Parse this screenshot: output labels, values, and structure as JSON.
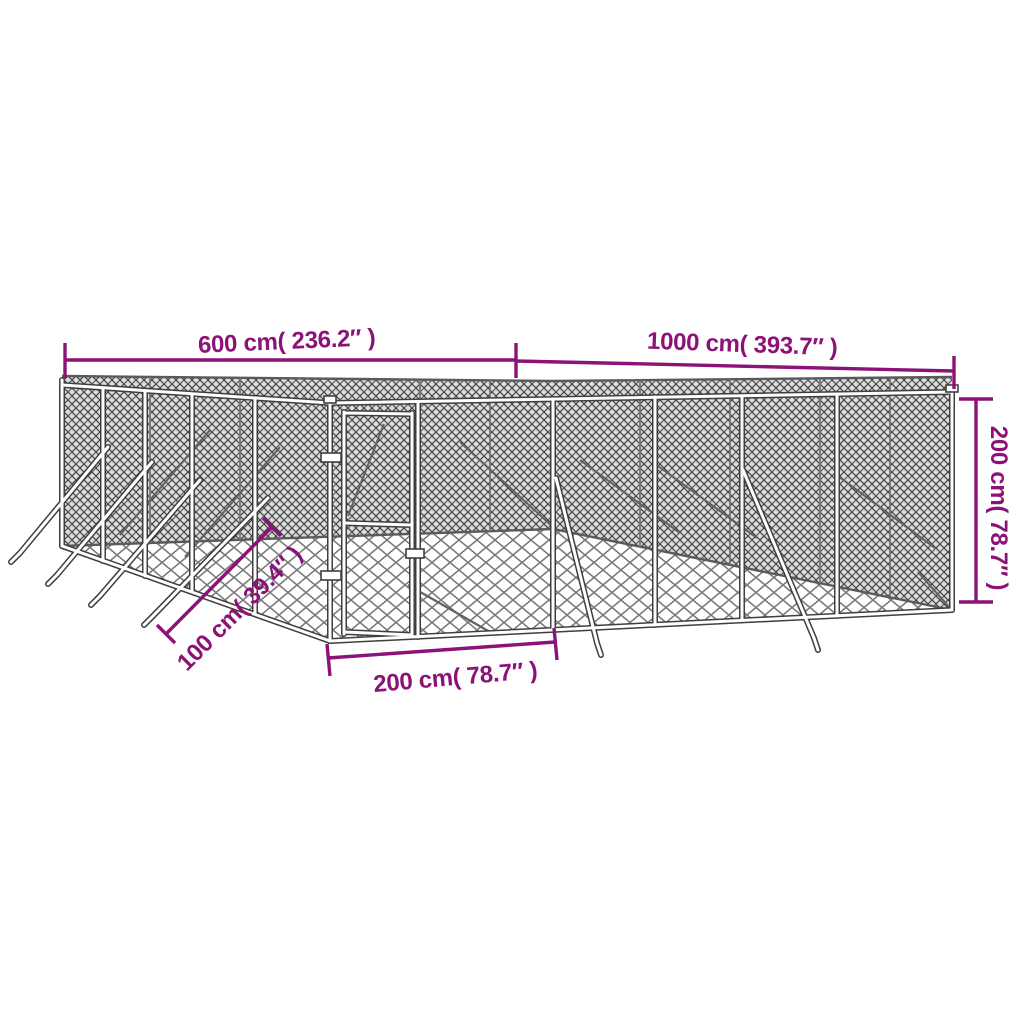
{
  "figure": {
    "kind": "product-dimension-diagram",
    "subject": "chain-link-dog-kennel-with-gate",
    "background": "#ffffff"
  },
  "colors": {
    "dimension_accent": "#8C1277",
    "frame_outline": "#3f3f3f",
    "mesh_dark_line": "#3d3d3d",
    "mesh_light_line": "#787878"
  },
  "dimensions": {
    "front_width": {
      "label": "600 cm( 236.2″ )"
    },
    "side_length": {
      "label": "1000 cm( 393.7″ )"
    },
    "height": {
      "label": "200 cm( 78.7″ )"
    },
    "brace_ground_offset": {
      "label": "100 cm( 39.4″ )"
    },
    "gate_width": {
      "label": "200 cm( 78.7″ )"
    }
  }
}
